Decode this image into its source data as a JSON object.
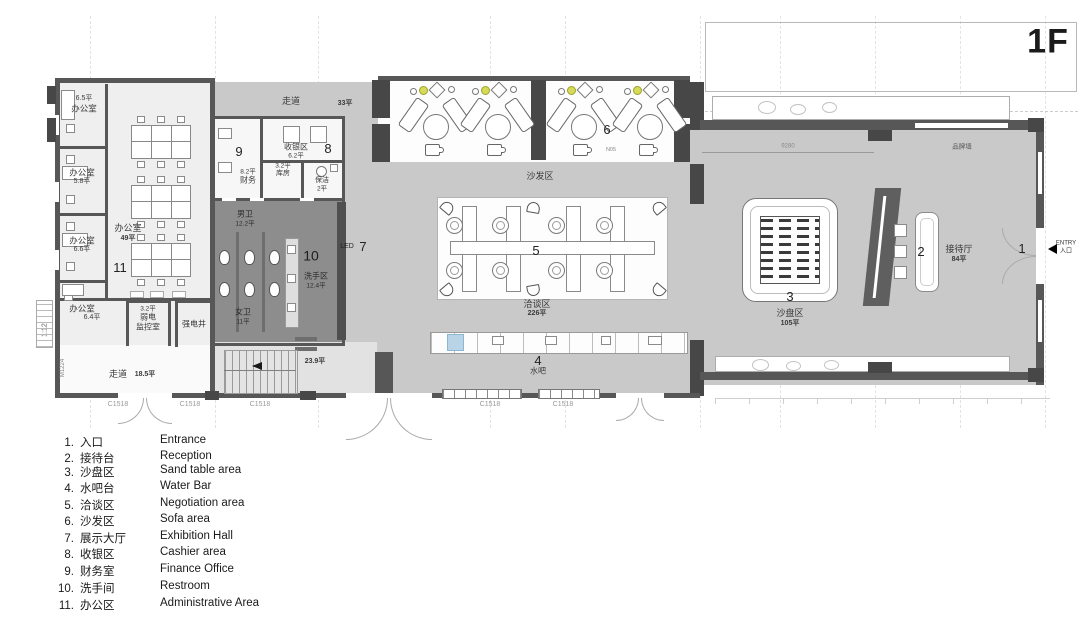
{
  "title": "1F",
  "plan": {
    "grid_label": "M—2",
    "dimension": "9280",
    "brand_wall": "品牌墙",
    "entry": {
      "line1": "ENTRY",
      "line2": "入口"
    },
    "rooms": {
      "office1": {
        "area": "6.5平",
        "name": "办公室"
      },
      "office2": {
        "name": "办公室",
        "area": "5.8平"
      },
      "office3": {
        "name": "办公室",
        "area": "6.6平"
      },
      "office4": {
        "name": "办公室",
        "area": "6.4平"
      },
      "open_office": {
        "name": "办公室",
        "area": "49平",
        "num": "11"
      },
      "monitor_room": {
        "area": "3.2平",
        "name1": "弱电",
        "name2": "监控室"
      },
      "power_shaft": {
        "name": "强电井"
      },
      "corridor_left": {
        "name": "走道",
        "area": "18.5平"
      },
      "corridor_top": {
        "name": "走道",
        "area": "33平"
      },
      "finance": {
        "num": "9",
        "area": "8.2平",
        "name": "财务"
      },
      "cashier": {
        "num": "8",
        "name": "收银区",
        "area": "6.2平"
      },
      "storage": {
        "area": "3.2平",
        "name": "库房"
      },
      "cleaning": {
        "name": "保洁",
        "area": "2平"
      },
      "male_wc": {
        "name": "男卫",
        "area": "12.2平"
      },
      "female_wc": {
        "name": "女卫",
        "area": "11平"
      },
      "washing": {
        "num": "10",
        "name": "洗手区",
        "area": "12.4平"
      },
      "led_wall": {
        "label": "LED",
        "num": "7"
      },
      "sofa_area": {
        "num": "6",
        "name": "沙发区",
        "tag": "N05"
      },
      "negotiation": {
        "num": "5",
        "name": "洽谈区",
        "area": "226平"
      },
      "water_bar": {
        "num": "4",
        "name": "水吧"
      },
      "sand_table": {
        "num": "3",
        "name": "沙盘区",
        "area": "105平"
      },
      "reception_desk": {
        "num": "2"
      },
      "reception_hall": {
        "num": "1",
        "name": "接待厅",
        "area": "84平"
      },
      "stairs": {
        "area": "23.9平"
      }
    },
    "tags": {
      "door": "M1224",
      "ramp": "1:12",
      "window": "C1518"
    }
  },
  "legend": {
    "items": [
      {
        "num": "1.",
        "zh": "入口",
        "en": "Entrance"
      },
      {
        "num": "2.",
        "zh": "接待台",
        "en": "Reception"
      },
      {
        "num": "3.",
        "zh": "沙盘区",
        "en": "Sand table area"
      },
      {
        "num": "4.",
        "zh": "水吧台",
        "en": "Water Bar"
      },
      {
        "num": "5.",
        "zh": "洽谈区",
        "en": "Negotiation area"
      },
      {
        "num": "6.",
        "zh": "沙发区",
        "en": "Sofa area"
      },
      {
        "num": "7.",
        "zh": "展示大厅",
        "en": "Exhibition Hall"
      },
      {
        "num": "8.",
        "zh": "收银区",
        "en": "Cashier area"
      },
      {
        "num": "9.",
        "zh": "财务室",
        "en": "Finance Office"
      },
      {
        "num": "10.",
        "zh": "洗手间",
        "en": "Restroom"
      },
      {
        "num": "11.",
        "zh": "办公区",
        "en": "Administrative Area"
      }
    ]
  },
  "colors": {
    "wall": "#575757",
    "hall_gray": "#c9c9c9",
    "restroom_gray": "#8d8d8d",
    "accent_green": "#d5da57",
    "water_blue": "#b9d4e6"
  }
}
